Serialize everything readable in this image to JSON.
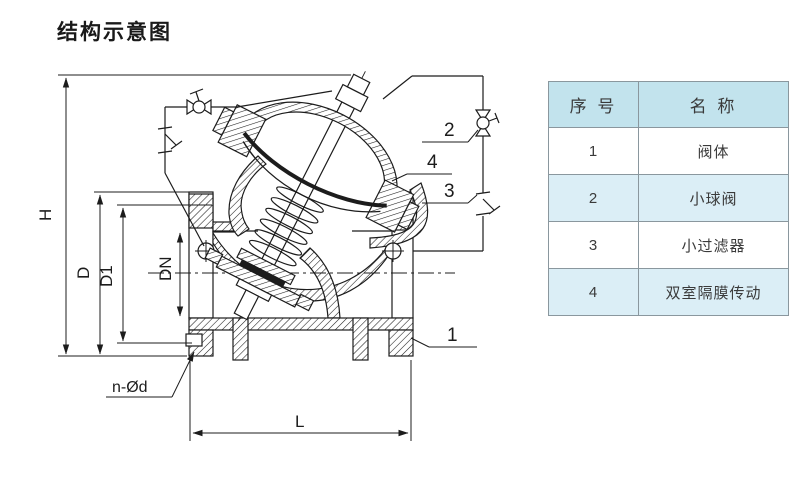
{
  "title": "结构示意图",
  "diagram": {
    "callouts": {
      "c1": "1",
      "c2": "2",
      "c3": "3",
      "c4": "4"
    },
    "dimensions": {
      "H": "H",
      "D": "D",
      "D1": "D1",
      "DN": "DN",
      "L": "L",
      "bolt_holes": "n-Ød"
    }
  },
  "table": {
    "header": {
      "index": "序 号",
      "name": "名 称"
    },
    "rows": [
      {
        "index": "1",
        "name": "阀体"
      },
      {
        "index": "2",
        "name": "小球阀"
      },
      {
        "index": "3",
        "name": "小过滤器"
      },
      {
        "index": "4",
        "name": "双室隔膜传动"
      }
    ]
  },
  "colors": {
    "line": "#1c1c1c",
    "table_header_bg": "#c2e3ed",
    "table_alt_row_bg": "#dbeef6",
    "table_border": "#8a979e"
  }
}
